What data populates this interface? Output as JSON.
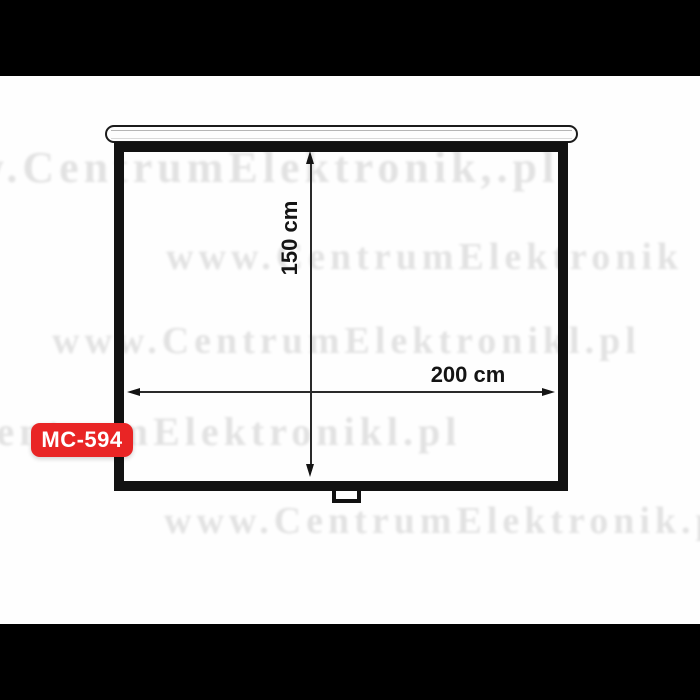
{
  "product": {
    "model_badge": "MC-594"
  },
  "drawing": {
    "type": "projection-screen-dimension-diagram",
    "height_label": "150 cm",
    "width_label": "200 cm",
    "height_value_cm": 150,
    "width_value_cm": 200
  },
  "watermarks": [
    {
      "text": "w.CentrumElektronik,.pl",
      "x": -28,
      "y": 146,
      "size": 44
    },
    {
      "text": "www.CentrumElektronik",
      "x": 166,
      "y": 238,
      "size": 38
    },
    {
      "text": "www.CentrumElektronikl.pl",
      "x": 52,
      "y": 322,
      "size": 38
    },
    {
      "text": "ww.CentrumElektronikl.pl",
      "x": -118,
      "y": 412,
      "size": 40
    },
    {
      "text": "www.CentrumElektronik.pl",
      "x": 164,
      "y": 502,
      "size": 38
    }
  ],
  "colors": {
    "badge_red": "#e92525",
    "ink": "#141414",
    "watermark_gray": "rgba(0,0,0,0.11)",
    "band_black": "#000000"
  }
}
